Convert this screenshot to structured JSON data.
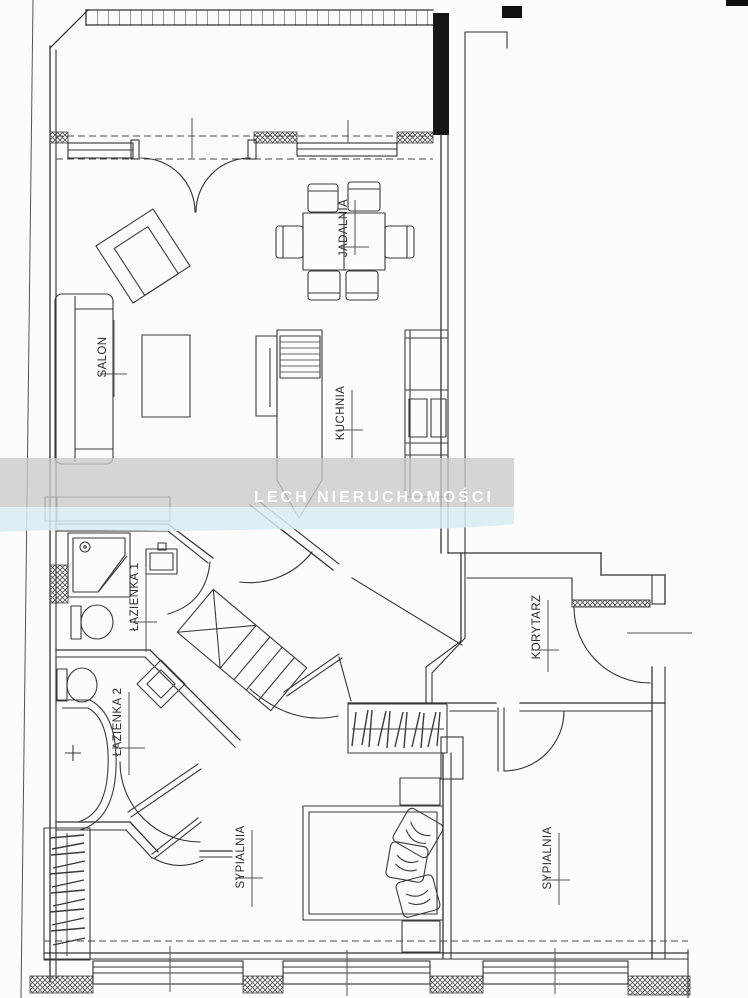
{
  "watermark": {
    "text": "LECH NIERUCHOMOŚCI",
    "band_gray": "#c9c9c9",
    "band_blue": "#d8ecf2",
    "text_color": "#fdfdfd"
  },
  "rooms": {
    "salon": {
      "label": "SALON"
    },
    "jadalnia": {
      "label": "JADALNIA"
    },
    "kuchnia": {
      "label": "KUCHNIA"
    },
    "lazienka1": {
      "label": "ŁAZIENKA 1"
    },
    "lazienka2": {
      "label": "ŁAZIENKA 2"
    },
    "korytarz": {
      "label": "KORYTARZ"
    },
    "sypialnia1": {
      "label": "SYPIALNIA"
    },
    "sypialnia2": {
      "label": "SYPIALNIA"
    }
  },
  "colors": {
    "line": "#333333",
    "background": "#fcfcfc"
  }
}
